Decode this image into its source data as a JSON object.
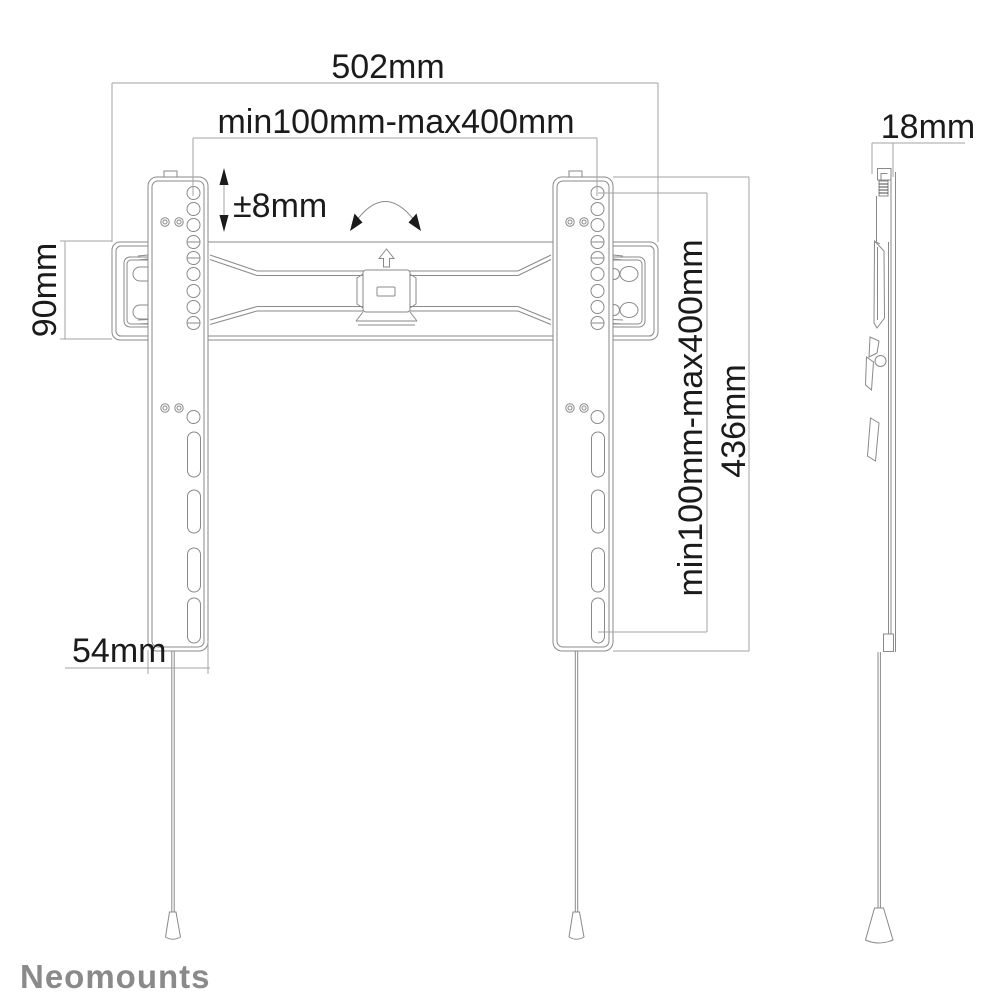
{
  "page": {
    "background": "#ffffff"
  },
  "drawing": {
    "type": "technical-line-drawing",
    "subject": "flat-panel TV wall mount, front view and side view",
    "line_color": "#8a8a8a",
    "dim_line_color": "#a3a3a3",
    "text_color": "#1b1b1b"
  },
  "dimensions": {
    "total_width": "502mm",
    "vesa_horizontal": "min100mm-max400mm",
    "vertical_adjustment": "±8mm",
    "plate_height": "90mm",
    "rail_width": "54mm",
    "vesa_vertical": "min100mm-max400mm",
    "rail_height": "436mm",
    "depth": "18mm"
  },
  "brand": {
    "name": "Neomounts",
    "color": "#8a8a8a"
  },
  "icons": {
    "tilt_arc": "rotation-arc-arrow",
    "lift_arrow": "up-arrow-outline",
    "adjust_arrow": "double-vertical-arrow"
  }
}
